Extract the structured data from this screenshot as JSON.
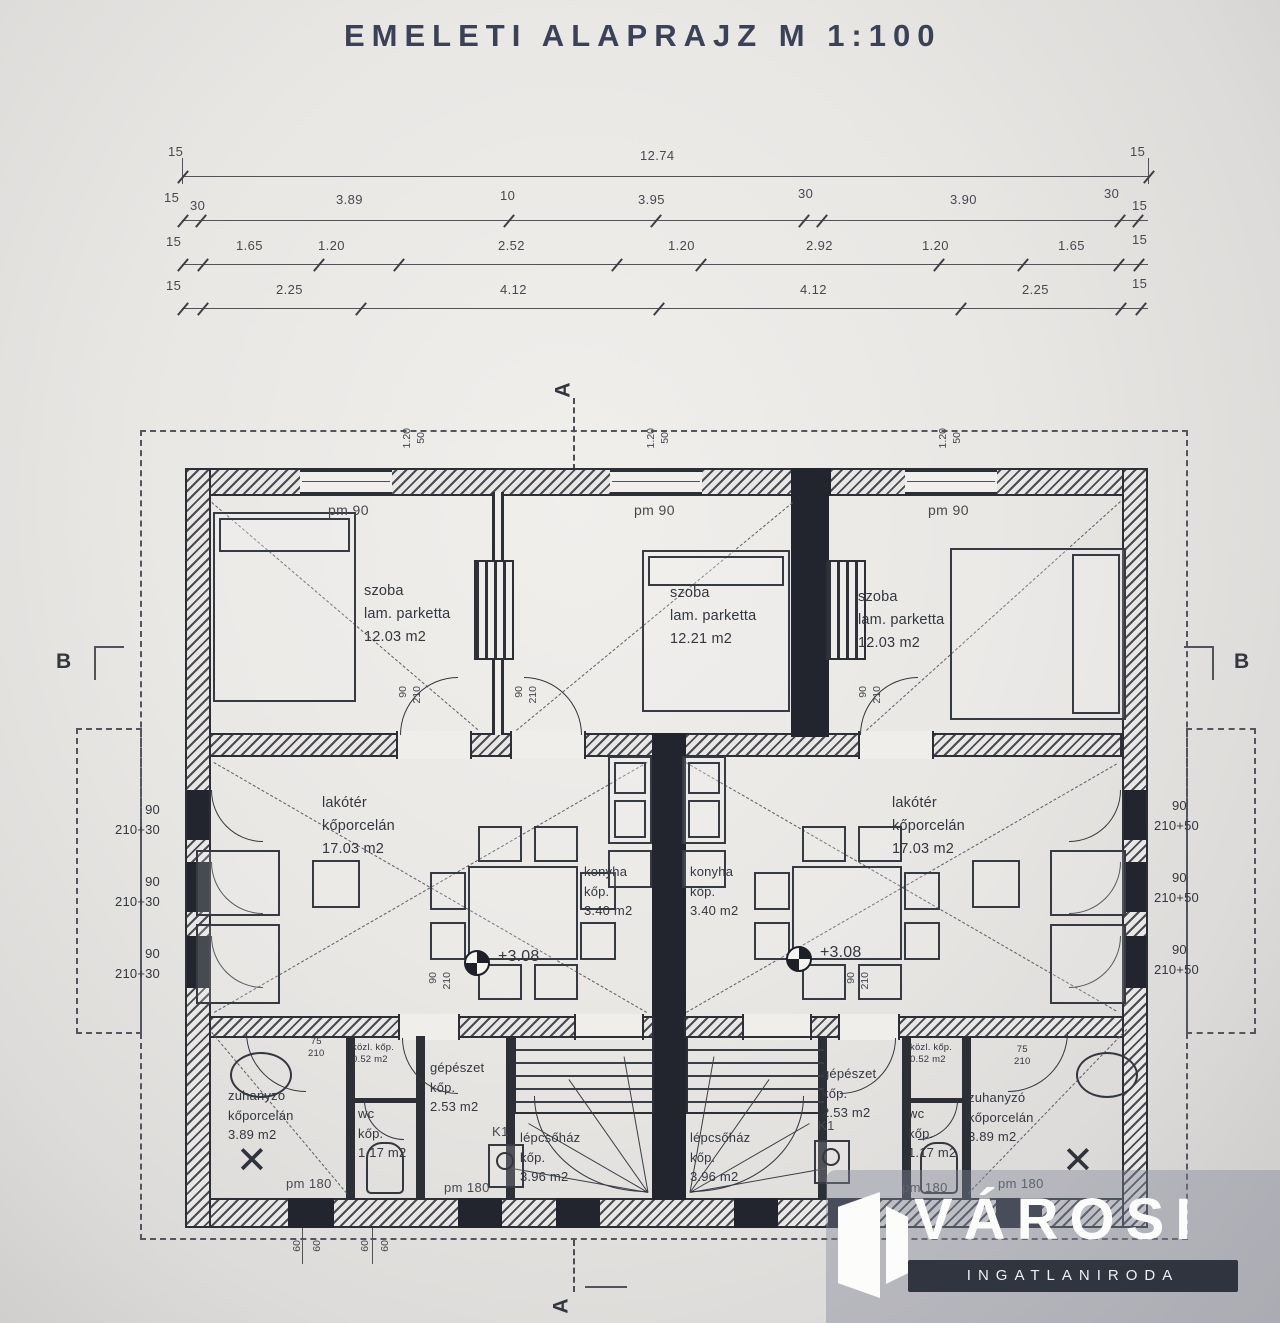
{
  "title": "EMELETI ALAPRAJZ M 1:100",
  "dims": {
    "row1": [
      "15",
      "12.74",
      "15"
    ],
    "row2": [
      "15",
      "30",
      "3.89",
      "10",
      "3.95",
      "30",
      "3.90",
      "30",
      "15"
    ],
    "row3": [
      "15",
      "1.65",
      "1.20",
      "2.52",
      "1.20",
      "2.92",
      "1.20",
      "1.65",
      "15"
    ],
    "row4": [
      "15",
      "2.25",
      "4.12",
      "4.12",
      "2.25",
      "15"
    ]
  },
  "rooms": {
    "bedroom_left": {
      "name": "szoba",
      "floor": "lam. parketta",
      "area": "12.03 m2"
    },
    "bedroom_center": {
      "name": "szoba",
      "floor": "lam. parketta",
      "area": "12.21 m2"
    },
    "bedroom_right": {
      "name": "szoba",
      "floor": "lam. parketta",
      "area": "12.03 m2"
    },
    "living_left": {
      "name": "lakótér",
      "floor": "kőporcelán",
      "area": "17.03 m2"
    },
    "living_right": {
      "name": "lakótér",
      "floor": "kőporcelán",
      "area": "17.03 m2"
    },
    "kitchen_left": {
      "name": "konyha",
      "floor": "kőp.",
      "area": "3.40 m2"
    },
    "kitchen_right": {
      "name": "konyha",
      "floor": "kőp.",
      "area": "3.40 m2"
    },
    "shower_left": {
      "name": "zuhanyzó",
      "floor": "kőporcelán",
      "area": "3.89 m2"
    },
    "shower_right": {
      "name": "zuhanyzó",
      "floor": "kőporcelán",
      "area": "3.89 m2"
    },
    "wc_left": {
      "name": "wc",
      "floor": "kőp.",
      "area": "1.17 m2"
    },
    "wc_right": {
      "name": "wc",
      "floor": "kőp.",
      "area": "1.17 m2"
    },
    "mech_left": {
      "name": "gépészet",
      "floor": "kőp.",
      "area": "2.53 m2"
    },
    "mech_right": {
      "name": "gépészet",
      "floor": "kőp.",
      "area": "2.53 m2"
    },
    "stair_left": {
      "name": "lépcsőház",
      "floor": "kőp.",
      "area": "3.96 m2"
    },
    "stair_right": {
      "name": "lépcsőház",
      "floor": "kőp.",
      "area": "3.96 m2"
    },
    "hall_left": {
      "name": "közl. kőp.",
      "area": "0.52 m2"
    },
    "hall_right": {
      "name": "közl. kőp.",
      "area": "0.52 m2"
    }
  },
  "labels": {
    "pm90": "pm 90",
    "pm180": "pm 180",
    "d90": "90",
    "d210": "210",
    "d75": "75",
    "w120": "1.20",
    "h50": "50",
    "s60": "60",
    "win90": "90",
    "par30": "210+30",
    "par50": "210+50",
    "level": "+3.08",
    "k1": "K1"
  },
  "sections": {
    "a": "A",
    "b": "B"
  },
  "watermark": {
    "name": "VÁROSI",
    "sub": "INGATLANIRODA"
  }
}
